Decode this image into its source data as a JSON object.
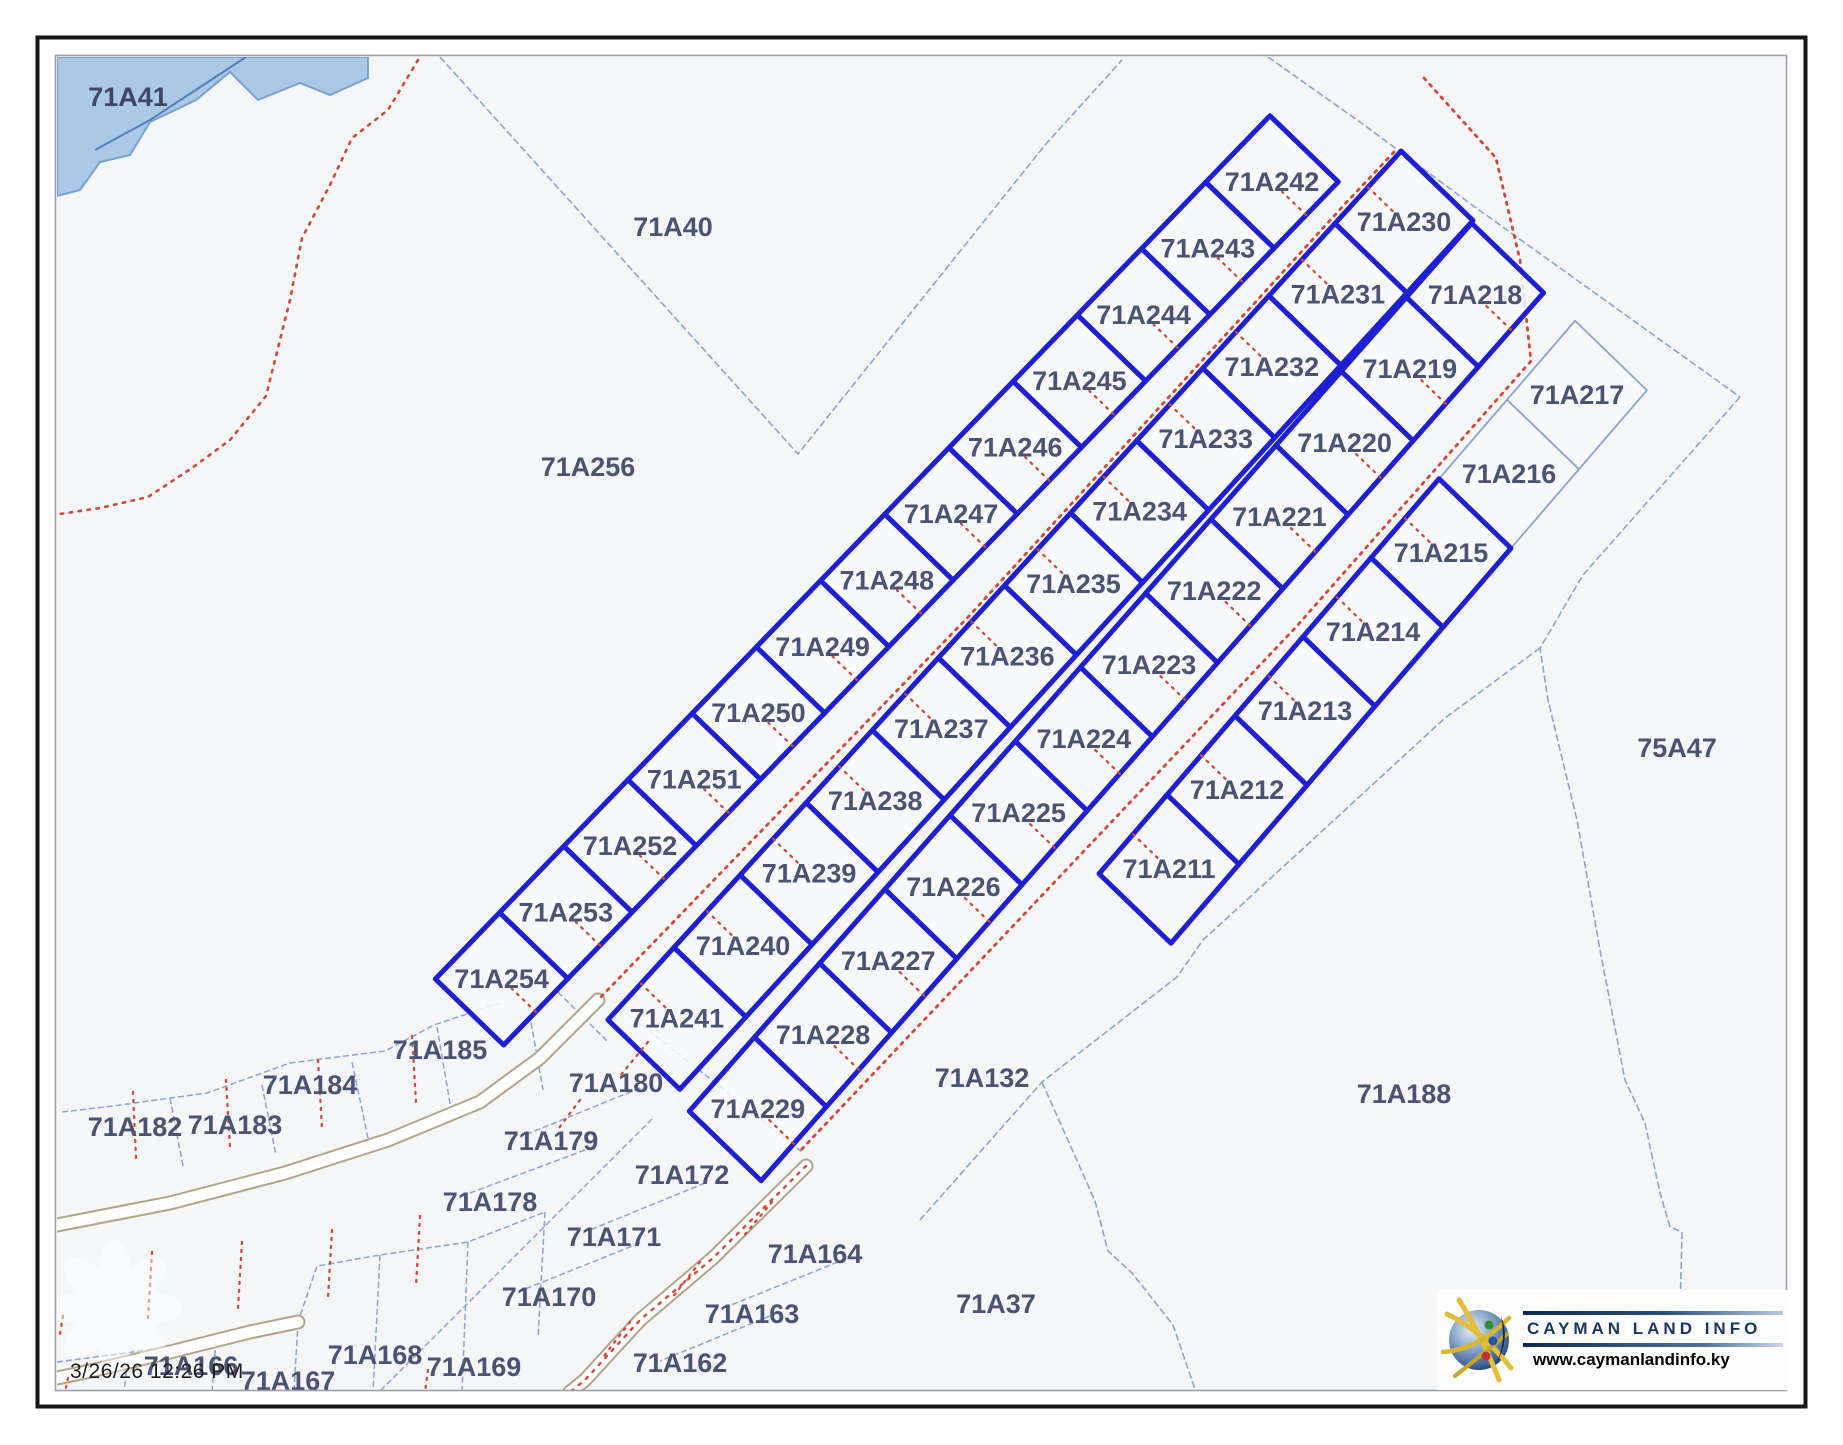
{
  "meta": {
    "timestamp": "3/26/26 12:26 PM"
  },
  "logo": {
    "title": "CAYMAN LAND INFO",
    "website": "www.caymanlandinfo.ky"
  },
  "colors": {
    "map_bg": "#f5f6f8",
    "parcel_fill": "#f8f9fb",
    "thick_blue": "#1e1ed2",
    "thin_blue": "#8aa4d1",
    "label": "#4a5374",
    "red_dots": "#cf4a3a",
    "water_fill": "#abc8e6",
    "water_edge": "#78a1cf",
    "water_line": "#4f7fbe",
    "road_tan": "#b3a489",
    "border_black": "#161616",
    "border_gray": "#9aa0a6"
  },
  "water": {
    "label": "71A41",
    "label_pos": [
      128,
      97
    ],
    "polygon": [
      [
        57,
        57
      ],
      [
        368,
        57
      ],
      [
        368,
        78
      ],
      [
        330,
        95
      ],
      [
        300,
        83
      ],
      [
        258,
        100
      ],
      [
        230,
        72
      ],
      [
        196,
        100
      ],
      [
        150,
        122
      ],
      [
        130,
        155
      ],
      [
        100,
        162
      ],
      [
        80,
        190
      ],
      [
        57,
        196
      ]
    ],
    "line": [
      [
        246,
        57
      ],
      [
        150,
        120
      ],
      [
        95,
        150
      ]
    ]
  },
  "region_labels": [
    {
      "id": "71A40",
      "x": 673,
      "y": 227
    },
    {
      "id": "71A256",
      "x": 588,
      "y": 467
    },
    {
      "id": "75A47",
      "x": 1677,
      "y": 748
    },
    {
      "id": "71A132",
      "x": 982,
      "y": 1078
    },
    {
      "id": "71A188",
      "x": 1404,
      "y": 1094
    },
    {
      "id": "71A37",
      "x": 996,
      "y": 1304
    },
    {
      "id": "71A185",
      "x": 440,
      "y": 1050
    },
    {
      "id": "71A184",
      "x": 310,
      "y": 1085
    },
    {
      "id": "71A183",
      "x": 235,
      "y": 1125
    },
    {
      "id": "71A182",
      "x": 135,
      "y": 1127
    },
    {
      "id": "71A180",
      "x": 616,
      "y": 1083
    },
    {
      "id": "71A179",
      "x": 551,
      "y": 1141
    },
    {
      "id": "71A178",
      "x": 490,
      "y": 1202
    },
    {
      "id": "71A172",
      "x": 682,
      "y": 1175
    },
    {
      "id": "71A171",
      "x": 614,
      "y": 1237
    },
    {
      "id": "71A170",
      "x": 549,
      "y": 1297
    },
    {
      "id": "71A164",
      "x": 815,
      "y": 1254
    },
    {
      "id": "71A163",
      "x": 752,
      "y": 1314
    },
    {
      "id": "71A162",
      "x": 680,
      "y": 1363
    },
    {
      "id": "71A166",
      "x": 191,
      "y": 1366
    },
    {
      "id": "71A167",
      "x": 288,
      "y": 1381
    },
    {
      "id": "71A168",
      "x": 375,
      "y": 1355
    },
    {
      "id": "71A169",
      "x": 474,
      "y": 1367
    }
  ],
  "strip": {
    "cross_dir": [
      0.719,
      0.695
    ],
    "columns": [
      {
        "origin": [
          1272,
          182
        ],
        "step": [
          -64.2,
          66.4
        ],
        "width": 95,
        "stub_side": 1,
        "parcels": [
          "71A242",
          "71A243",
          "71A244",
          "71A245",
          "71A246",
          "71A247",
          "71A248",
          "71A249",
          "71A250",
          "71A251",
          "71A252",
          "71A253",
          "71A254"
        ],
        "thin": []
      },
      {
        "origin": [
          1404,
          222
        ],
        "step": [
          -66.1,
          72.4
        ],
        "width": 100,
        "stub_side": -1,
        "parcels": [
          "71A230",
          "71A231",
          "71A232",
          "71A233",
          "71A234",
          "71A235",
          "71A236",
          "71A237",
          "71A238",
          "71A239",
          "71A240",
          "71A241"
        ],
        "thin": []
      },
      {
        "origin": [
          1475,
          295
        ],
        "step": [
          -65.2,
          74.0
        ],
        "width": 100,
        "stub_side": 1,
        "parcels": [
          "71A218",
          "71A219",
          "71A220",
          "71A221",
          "71A222",
          "71A223",
          "71A224",
          "71A225",
          "71A226",
          "71A227",
          "71A228",
          "71A229"
        ],
        "thin": []
      },
      {
        "origin": [
          1577,
          395
        ],
        "step": [
          -68,
          79
        ],
        "width": 100,
        "stub_side": -1,
        "parcels": [
          "71A217",
          "71A216",
          "71A215",
          "71A214",
          "71A213",
          "71A212",
          "71A211"
        ],
        "thin": [
          "71A217",
          "71A216"
        ]
      }
    ]
  },
  "roads": {
    "centerline1": [
      [
        1394,
        152
      ],
      [
        1345,
        204
      ],
      [
        970,
        615
      ],
      [
        598,
        1000
      ]
    ],
    "centerline2": [
      [
        1424,
        78
      ],
      [
        1496,
        158
      ],
      [
        1520,
        260
      ],
      [
        1531,
        361
      ],
      [
        1296,
        627
      ],
      [
        801,
        1150
      ]
    ],
    "corridor1": [
      [
        598,
        1000
      ],
      [
        540,
        1058
      ],
      [
        480,
        1102
      ],
      [
        388,
        1140
      ],
      [
        285,
        1173
      ],
      [
        170,
        1203
      ],
      [
        57,
        1225
      ]
    ],
    "corridor2": [
      [
        806,
        1166
      ],
      [
        713,
        1258
      ],
      [
        640,
        1320
      ],
      [
        585,
        1380
      ],
      [
        570,
        1392
      ]
    ],
    "corridor3": [
      [
        57,
        1378
      ],
      [
        95,
        1370
      ],
      [
        170,
        1352
      ],
      [
        250,
        1332
      ],
      [
        298,
        1322
      ]
    ]
  },
  "boundaries": [
    [
      [
        440,
        57
      ],
      [
        798,
        454
      ],
      [
        1045,
        145
      ],
      [
        1122,
        60
      ]
    ],
    [
      [
        1268,
        57
      ],
      [
        1360,
        122
      ],
      [
        1468,
        202
      ],
      [
        1740,
        397
      ]
    ],
    [
      [
        1740,
        397
      ],
      [
        1583,
        575
      ],
      [
        1540,
        648
      ],
      [
        1548,
        700
      ],
      [
        1577,
        820
      ],
      [
        1600,
        950
      ],
      [
        1625,
        1080
      ],
      [
        1645,
        1123
      ],
      [
        1660,
        1193
      ],
      [
        1670,
        1227
      ],
      [
        1682,
        1232
      ],
      [
        1680,
        1313
      ],
      [
        1678,
        1392
      ]
    ],
    [
      [
        1540,
        648
      ],
      [
        1445,
        718
      ],
      [
        1307,
        845
      ],
      [
        1203,
        940
      ],
      [
        1177,
        977
      ]
    ],
    [
      [
        920,
        1220
      ],
      [
        1042,
        1082
      ],
      [
        1177,
        977
      ]
    ],
    [
      [
        1042,
        1082
      ],
      [
        1095,
        1201
      ],
      [
        1108,
        1251
      ],
      [
        1132,
        1273
      ],
      [
        1173,
        1325
      ],
      [
        1196,
        1392
      ]
    ]
  ],
  "network": [
    [
      [
        62,
        1112
      ],
      [
        113,
        1106
      ],
      [
        207,
        1093
      ],
      [
        290,
        1063
      ],
      [
        385,
        1051
      ],
      [
        434,
        1025
      ],
      [
        500,
        1003
      ]
    ],
    [
      [
        170,
        1098
      ],
      [
        183,
        1166
      ]
    ],
    [
      [
        262,
        1085
      ],
      [
        276,
        1155
      ]
    ],
    [
      [
        352,
        1062
      ],
      [
        368,
        1138
      ]
    ],
    [
      [
        437,
        1027
      ],
      [
        452,
        1115
      ]
    ],
    [
      [
        528,
        1005
      ],
      [
        543,
        1090
      ]
    ],
    [
      [
        558,
        992
      ],
      [
        608,
        1042
      ]
    ],
    [
      [
        652,
        1119
      ],
      [
        560,
        1211
      ],
      [
        460,
        1311
      ],
      [
        380,
        1391
      ]
    ],
    [
      [
        57,
        1362
      ],
      [
        133,
        1352
      ],
      [
        235,
        1337
      ],
      [
        298,
        1322
      ],
      [
        317,
        1266
      ],
      [
        380,
        1255
      ],
      [
        468,
        1242
      ],
      [
        545,
        1212
      ]
    ],
    [
      [
        128,
        1354
      ],
      [
        124,
        1392
      ]
    ],
    [
      [
        216,
        1341
      ],
      [
        212,
        1392
      ]
    ],
    [
      [
        298,
        1322
      ],
      [
        294,
        1392
      ]
    ],
    [
      [
        380,
        1255
      ],
      [
        373,
        1392
      ]
    ],
    [
      [
        468,
        1242
      ],
      [
        462,
        1392
      ]
    ],
    [
      [
        545,
        1212
      ],
      [
        538,
        1338
      ]
    ],
    [
      [
        620,
        1008
      ],
      [
        718,
        1085
      ],
      [
        802,
        1152
      ]
    ],
    [
      [
        640,
        1088
      ],
      [
        520,
        1137
      ]
    ],
    [
      [
        585,
        1150
      ],
      [
        462,
        1196
      ]
    ],
    [
      [
        705,
        1183
      ],
      [
        590,
        1230
      ]
    ],
    [
      [
        640,
        1243
      ],
      [
        520,
        1291
      ]
    ],
    [
      [
        838,
        1262
      ],
      [
        726,
        1307
      ]
    ],
    [
      [
        770,
        1316
      ],
      [
        660,
        1361
      ]
    ]
  ],
  "red_lines": [
    [
      [
        418,
        60
      ],
      [
        388,
        110
      ],
      [
        352,
        138
      ],
      [
        330,
        185
      ],
      [
        302,
        238
      ],
      [
        290,
        300
      ],
      [
        266,
        396
      ],
      [
        230,
        440
      ],
      [
        192,
        468
      ],
      [
        148,
        497
      ],
      [
        100,
        508
      ],
      [
        60,
        514
      ]
    ]
  ],
  "red_stubs": [
    [
      [
        133,
        1092
      ],
      [
        136,
        1158
      ]
    ],
    [
      [
        226,
        1080
      ],
      [
        230,
        1148
      ]
    ],
    [
      [
        318,
        1060
      ],
      [
        322,
        1128
      ]
    ],
    [
      [
        412,
        1036
      ],
      [
        416,
        1102
      ]
    ],
    [
      [
        152,
        1252
      ],
      [
        148,
        1318
      ]
    ],
    [
      [
        242,
        1242
      ],
      [
        238,
        1308
      ]
    ],
    [
      [
        332,
        1230
      ],
      [
        328,
        1298
      ]
    ],
    [
      [
        420,
        1216
      ],
      [
        416,
        1286
      ]
    ],
    [
      [
        63,
        1316
      ],
      [
        60,
        1334
      ]
    ],
    [
      [
        68,
        1378
      ],
      [
        65,
        1392
      ]
    ],
    [
      [
        428,
        1370
      ],
      [
        425,
        1392
      ]
    ],
    [
      [
        772,
        1202
      ],
      [
        742,
        1238
      ]
    ],
    [
      [
        700,
        1262
      ],
      [
        672,
        1298
      ]
    ],
    [
      [
        630,
        1322
      ],
      [
        604,
        1356
      ]
    ],
    [
      [
        648,
        1042
      ],
      [
        620,
        1076
      ]
    ],
    [
      [
        580,
        1100
      ],
      [
        556,
        1132
      ]
    ]
  ],
  "watermark": {
    "cx": 115,
    "cy": 1308,
    "r": 62
  }
}
